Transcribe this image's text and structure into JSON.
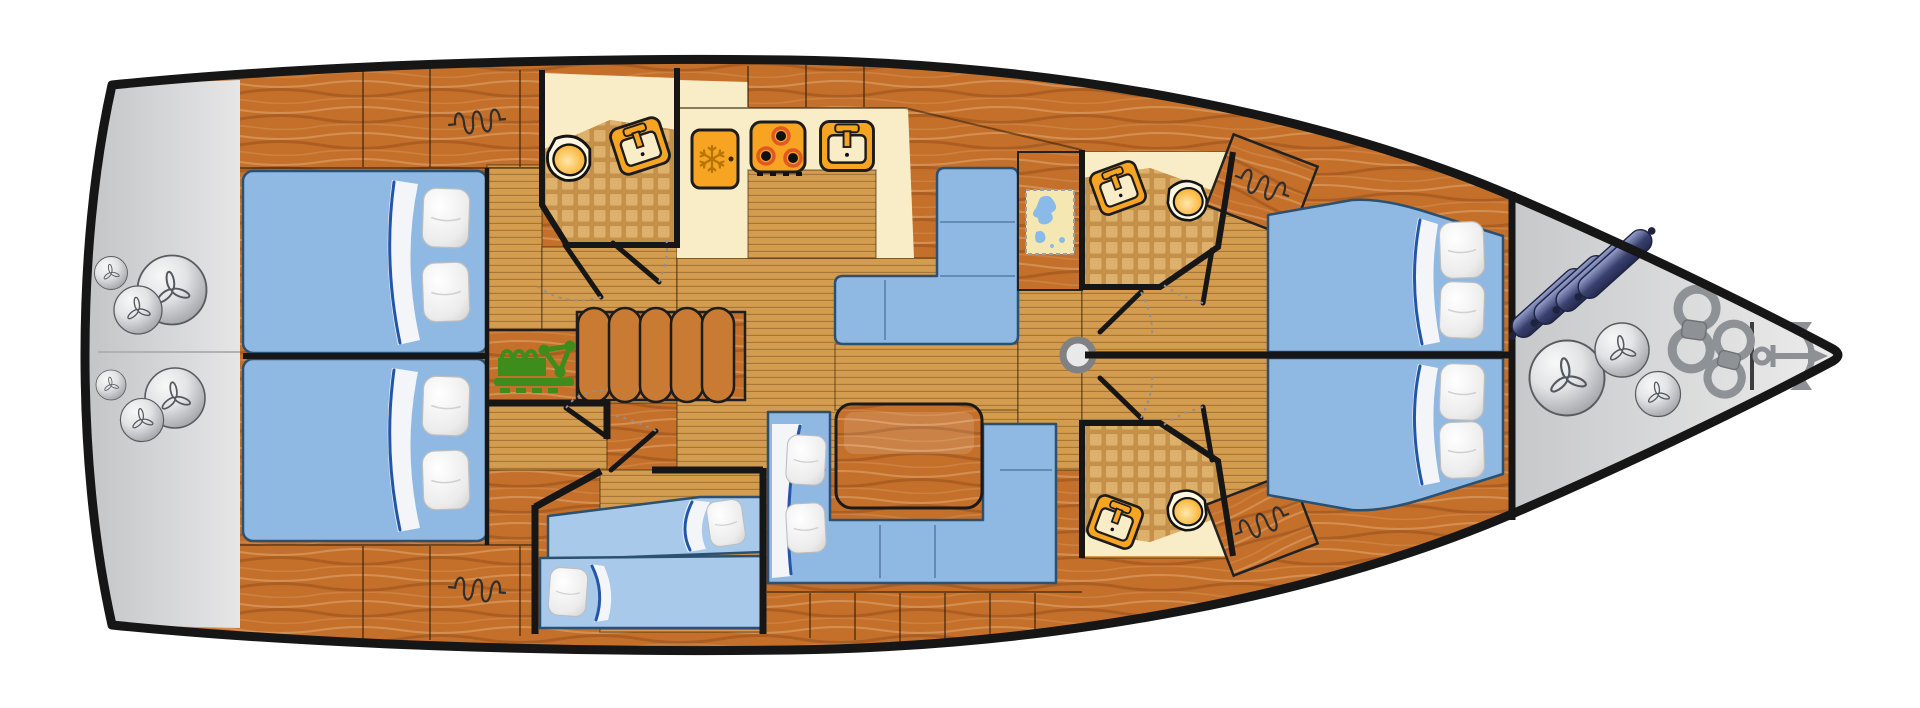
{
  "diagram": {
    "title": "Sailing yacht interior layout plan (top view, bow to the right)",
    "type": "yacht-floor-plan",
    "orientation": {
      "bow": "right",
      "stern": "left"
    },
    "colors": {
      "hull_outline": "#161616",
      "background": "#ffffff",
      "swim_platform": "#d6d7d8",
      "bow_locker": "#c9cacc",
      "wood_cabinet": "#c4702b",
      "deck_floor": "#d49c4e",
      "tile_grout": "#c5914a",
      "tile_square": "#ddb06b",
      "counter_cream": "#f9edc8",
      "appliance_orange": "#f6a422",
      "bed_blue": "#8fb9e3",
      "bed_blue_light": "#a9c9ea",
      "pillow_white": "#f5f5f5",
      "table_wood": "#c97a33",
      "engine_green": "#3e8c1c",
      "map_paper": "#f4e7b2",
      "map_water": "#8abbe8",
      "fender_ball": "#c9cbcf",
      "fender_cylinder": "#3a4170",
      "rope_gray": "#8e9196",
      "anchor_gray": "#8d9095",
      "mast_gray": "#e9e9e9",
      "wall_black": "#161616",
      "door_arc": "#909090",
      "burner_glow": "#e25822",
      "snowflake": "#b87400",
      "sheet_fold": "#2456a8"
    },
    "areas": [
      {
        "id": "swim-platform",
        "label": "Stern swim platform with two clusters of three ball fenders"
      },
      {
        "id": "aft-cabin-port",
        "label": "Aft double cabin, port side, with two pillows"
      },
      {
        "id": "aft-cabin-starboard",
        "label": "Aft double cabin, starboard side, with two pillows"
      },
      {
        "id": "aft-head",
        "label": "Aft bathroom with toilet and tilted washbasin on tiled floor"
      },
      {
        "id": "galley",
        "label": "Galley with fridge, three-burner stove and sink on cream counter"
      },
      {
        "id": "settee",
        "label": "L-shaped blue settee beside the galley"
      },
      {
        "id": "chart-table",
        "label": "Navigation chart table with sea map"
      },
      {
        "id": "salon-dinette",
        "label": "Salon U-shaped sofa with wooden table and two pillows"
      },
      {
        "id": "mid-cabin",
        "label": "Mid single-berth cabin with two single beds"
      },
      {
        "id": "engine-room",
        "label": "Engine compartment with folded table leaves"
      },
      {
        "id": "forward-head-port",
        "label": "Forward port bathroom with washbasin and toilet"
      },
      {
        "id": "forward-head-starboard",
        "label": "Forward starboard bathroom with washbasin and toilet"
      },
      {
        "id": "forward-cabin-port",
        "label": "Forward double cabin, port side"
      },
      {
        "id": "forward-cabin-starboard",
        "label": "Forward double cabin, starboard side"
      },
      {
        "id": "bow-locker",
        "label": "Bow anchor locker with cylinder fenders, ball fenders, mooring ropes and anchor"
      }
    ],
    "equipment": [
      {
        "id": "fridge",
        "label": "Refrigerator with snowflake symbol"
      },
      {
        "id": "stove",
        "label": "Three-burner stove"
      },
      {
        "id": "galley-sink",
        "label": "Galley sink with faucet"
      },
      {
        "id": "toilets",
        "label": "Toilet",
        "count": 3
      },
      {
        "id": "washbasins",
        "label": "Bathroom washbasin",
        "count": 3
      },
      {
        "id": "wardrobes",
        "label": "Hanging wardrobe (coil-spring symbol)",
        "count": 4
      },
      {
        "id": "mast-post",
        "label": "Mast support post"
      },
      {
        "id": "engine",
        "label": "Engine symbol"
      },
      {
        "id": "folding-table-leaves",
        "label": "Stored folding table leaves",
        "count": 5
      },
      {
        "id": "saloon-table",
        "label": "Wooden saloon table"
      },
      {
        "id": "chart-map",
        "label": "Nautical chart"
      },
      {
        "id": "ball-fenders-stern",
        "label": "Ball fender at stern",
        "count": 6
      },
      {
        "id": "ball-fenders-bow",
        "label": "Ball fender at bow",
        "count": 3
      },
      {
        "id": "cylinder-fenders",
        "label": "Cylindrical fender",
        "count": 4
      },
      {
        "id": "mooring-ropes",
        "label": "Coiled mooring rope",
        "count": 2
      },
      {
        "id": "anchor",
        "label": "Anchor"
      }
    ],
    "berths": {
      "aft_doubles": 2,
      "forward_doubles": 2,
      "mid_singles": 2
    }
  }
}
